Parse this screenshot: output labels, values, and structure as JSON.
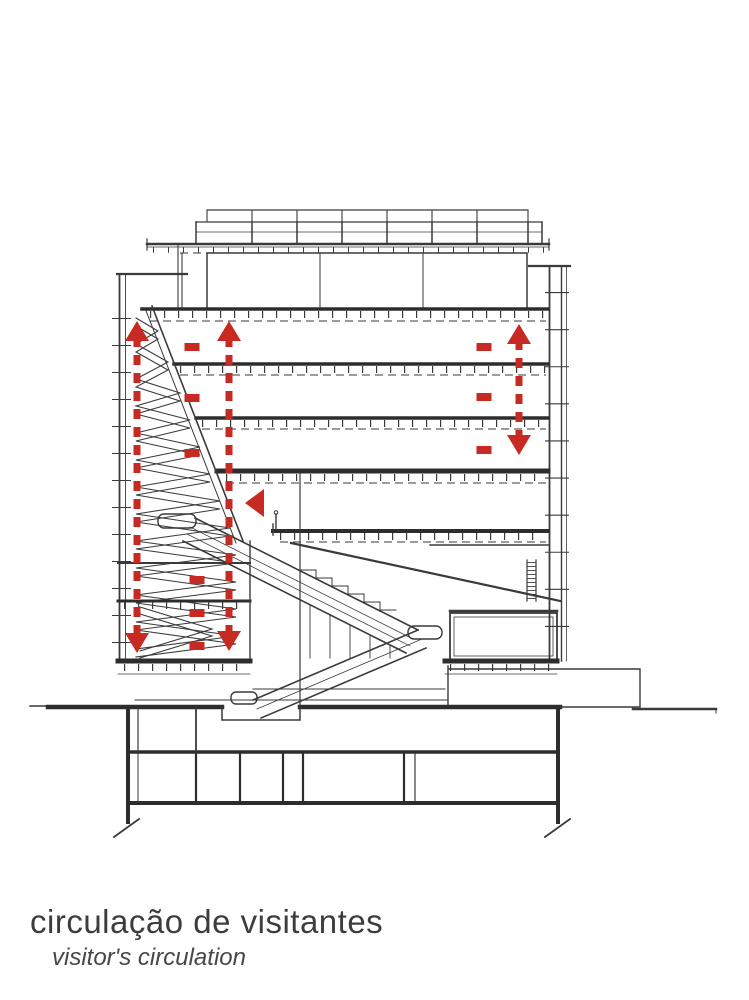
{
  "caption": {
    "title": "circulação de visitantes",
    "subtitle": "visitor's circulation",
    "title_color": "#3d3d3d",
    "subtitle_color": "#474747"
  },
  "drawing": {
    "description": "building cross-section line drawing",
    "line_color": "#3a3a3a",
    "heavy_line_color": "#2d2d2d"
  },
  "circulation": {
    "color": "#c62a22",
    "shaft_width": 7,
    "shaft_dash": "10 8",
    "head_width": 24,
    "head_height": 20,
    "vertical_arrows": [
      {
        "x": 137,
        "y_top": 321,
        "y_bottom": 653,
        "head_top": true,
        "head_bottom": true
      },
      {
        "x": 229,
        "y_top": 321,
        "y_bottom": 651,
        "head_top": true,
        "head_bottom": true
      },
      {
        "x": 519,
        "y_top": 324,
        "y_bottom": 455,
        "head_top": true,
        "head_bottom": true
      }
    ],
    "dashes": [
      {
        "x": 192,
        "y": 347
      },
      {
        "x": 192,
        "y": 398
      },
      {
        "x": 192,
        "y": 453
      },
      {
        "x": 197,
        "y": 580
      },
      {
        "x": 197,
        "y": 613
      },
      {
        "x": 197,
        "y": 646
      },
      {
        "x": 484,
        "y": 347
      },
      {
        "x": 484,
        "y": 397
      },
      {
        "x": 484,
        "y": 450
      }
    ],
    "dash_size": {
      "w": 15,
      "h": 8
    },
    "left_triangle": {
      "tip_x": 245,
      "tip_y": 503,
      "width": 19,
      "height": 28
    }
  }
}
